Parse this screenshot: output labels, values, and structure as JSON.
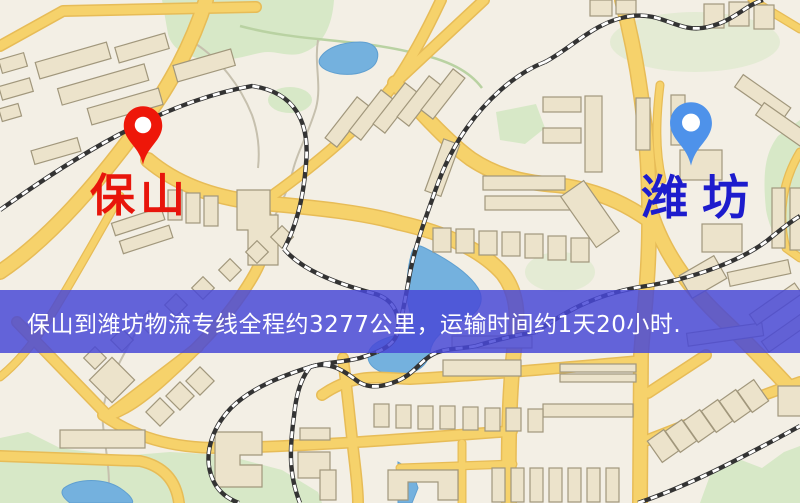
{
  "banner": {
    "text": "保山到潍坊物流专线全程约3277公里，运输时间约1天20小时.",
    "background_color": "rgba(72,72,214,0.84)",
    "text_color": "#ffffff"
  },
  "markers": {
    "origin": {
      "label": "保山",
      "pin_color": "#ee1709",
      "label_color": "#e8150b"
    },
    "destination": {
      "label": "潍坊",
      "pin_color": "#4e92ea",
      "label_color": "#1d1ccd"
    }
  },
  "map_style": {
    "background": "#f3efe5",
    "major_road_color": "#f6d26b",
    "road_casing_color": "#e7bc57",
    "building_color": "#ece3cb",
    "building_outline_color": "#a1977c",
    "park_color": "#d7e8c7",
    "water_color": "#74b1de",
    "railway_color": "#333333"
  }
}
